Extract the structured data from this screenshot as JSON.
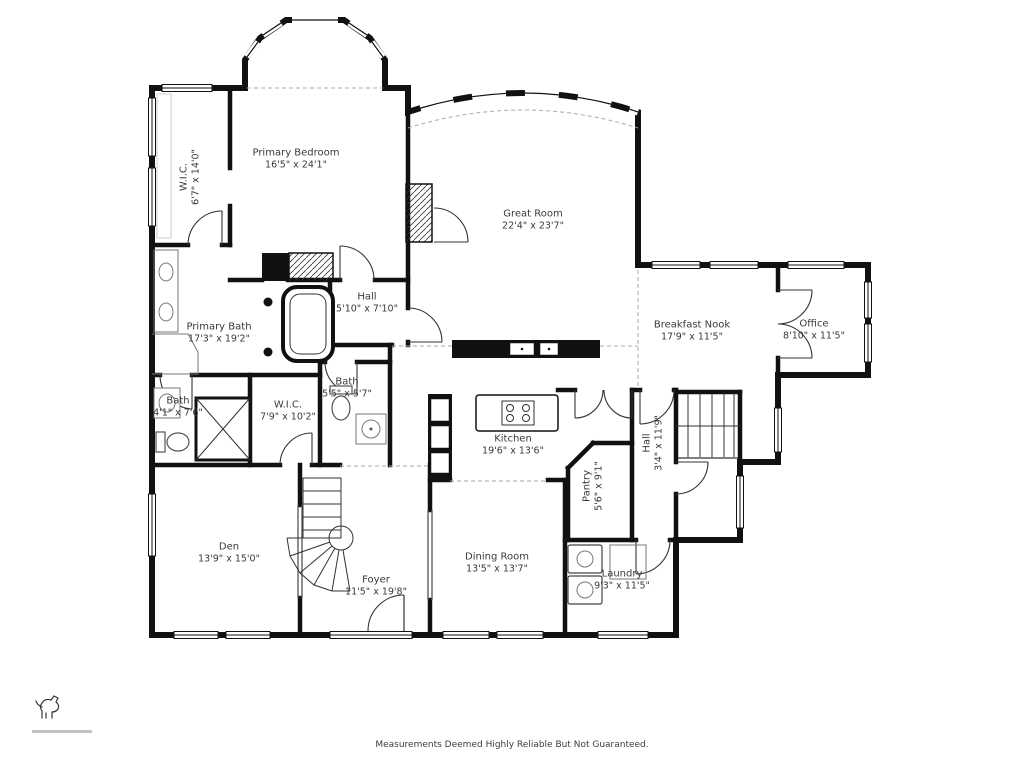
{
  "plan": {
    "type": "floor-plan",
    "line_color": "#111111",
    "background": "#ffffff"
  },
  "rooms": [
    {
      "id": "primary-bedroom",
      "name": "Primary Bedroom",
      "dims": "16'5\" x 24'1\""
    },
    {
      "id": "primary-wic",
      "name": "W.I.C.",
      "dims": "6'7\" x 14'0\""
    },
    {
      "id": "great-room",
      "name": "Great Room",
      "dims": "22'4\" x 23'7\""
    },
    {
      "id": "hall-upper",
      "name": "Hall",
      "dims": "5'10\" x 7'10\""
    },
    {
      "id": "primary-bath",
      "name": "Primary Bath",
      "dims": "17'3\" x 19'2\""
    },
    {
      "id": "breakfast-nook",
      "name": "Breakfast Nook",
      "dims": "17'9\" x 11'5\""
    },
    {
      "id": "office",
      "name": "Office",
      "dims": "8'10\" x 11'5\""
    },
    {
      "id": "bath-hall",
      "name": "Bath",
      "dims": "5'5\" x 5'7\""
    },
    {
      "id": "wic-second",
      "name": "W.I.C.",
      "dims": "7'9\" x 10'2\""
    },
    {
      "id": "bath-left",
      "name": "Bath",
      "dims": "4'1\" x 7'6\""
    },
    {
      "id": "kitchen",
      "name": "Kitchen",
      "dims": "19'6\" x 13'6\""
    },
    {
      "id": "hall-rear",
      "name": "Hall",
      "dims": "3'4\" x 11'9\""
    },
    {
      "id": "pantry",
      "name": "Pantry",
      "dims": "5'6\" x 9'1\""
    },
    {
      "id": "den",
      "name": "Den",
      "dims": "13'9\" x 15'0\""
    },
    {
      "id": "foyer",
      "name": "Foyer",
      "dims": "11'5\" x 19'8\""
    },
    {
      "id": "dining-room",
      "name": "Dining Room",
      "dims": "13'5\" x 13'7\""
    },
    {
      "id": "laundry",
      "name": "Laundry",
      "dims": "9'3\" x 11'5\""
    }
  ],
  "footer": {
    "disclaimer": "Measurements Deemed Highly Reliable But Not Guaranteed."
  }
}
